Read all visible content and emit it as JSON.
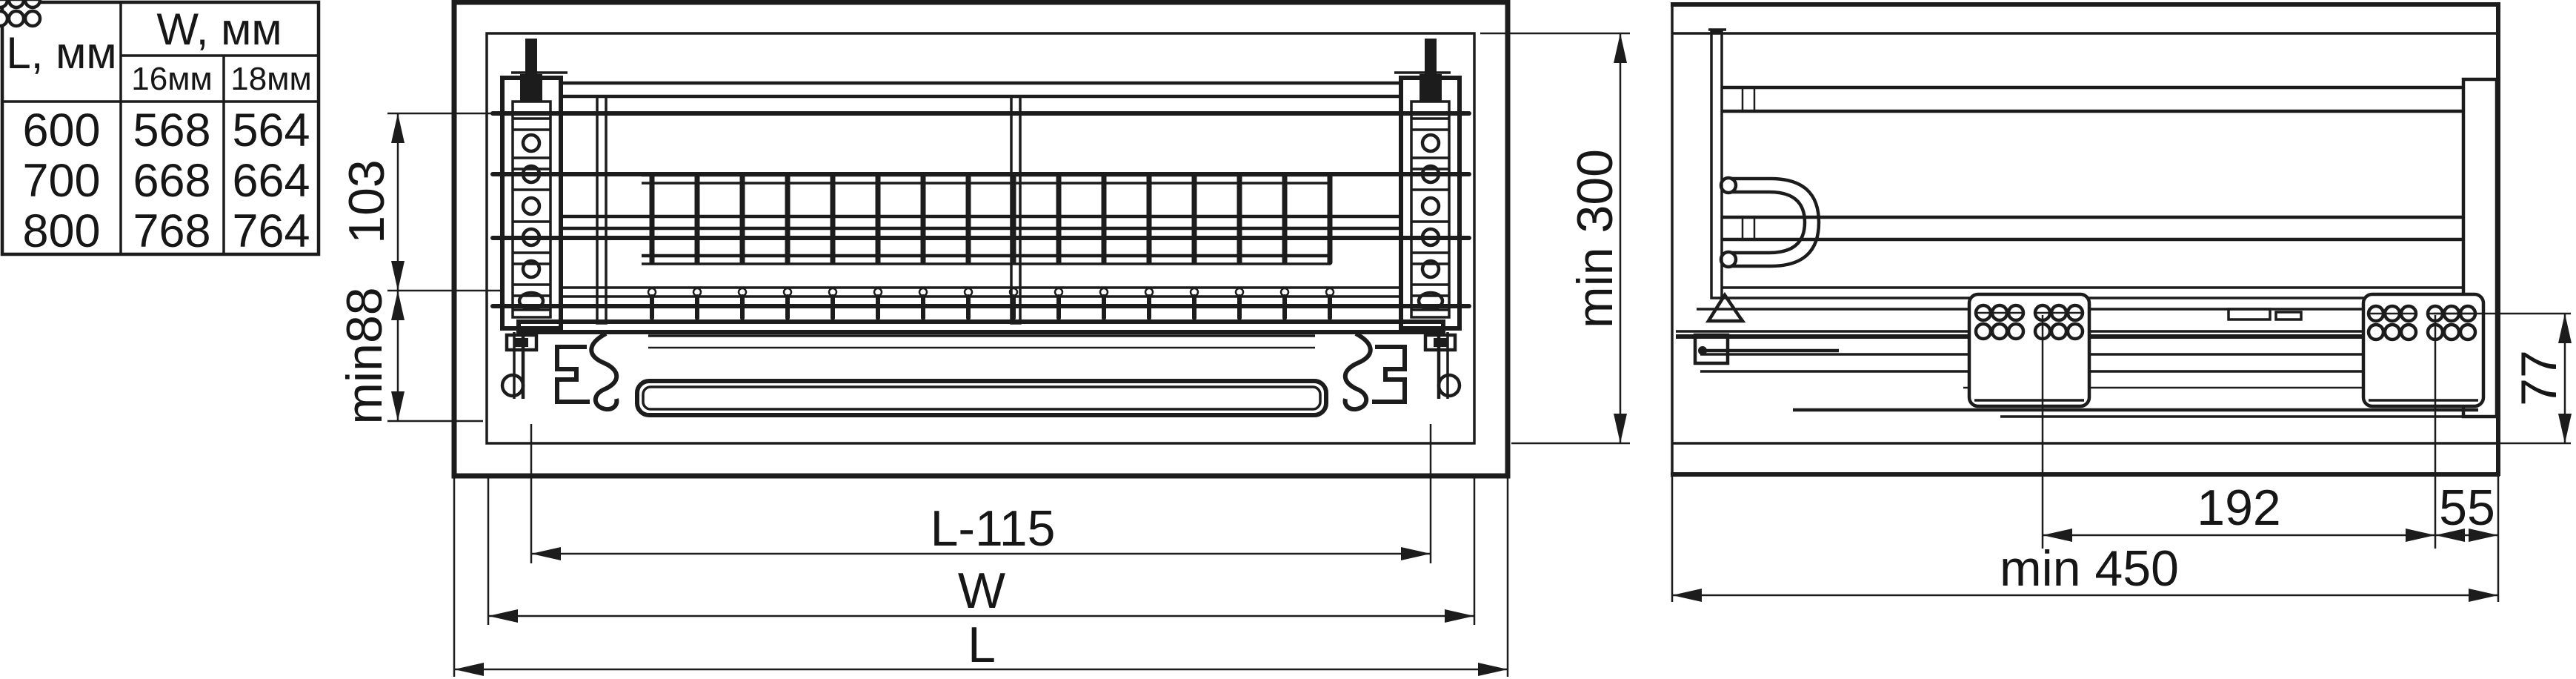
{
  "table": {
    "l_header": "L, мм",
    "w_header": "W, мм",
    "w_sub_16": "16мм",
    "w_sub_18": "18мм",
    "rows": [
      {
        "l": "600",
        "w16": "568",
        "w18": "564"
      },
      {
        "l": "700",
        "w16": "668",
        "w18": "664"
      },
      {
        "l": "800",
        "w16": "768",
        "w18": "764"
      }
    ]
  },
  "front_view": {
    "dim_top_section": "103",
    "dim_bottom_section": "min88",
    "dim_inner_height": "min 300",
    "dim_rail_span": "L-115",
    "dim_inner_width": "W",
    "dim_cabinet_width": "L"
  },
  "side_view": {
    "dim_slide_height": "77",
    "dim_hole_span": "192",
    "dim_back_gap": "55",
    "dim_min_depth": "min 450"
  },
  "colors": {
    "line": "#1c1c1c",
    "background": "#ffffff"
  }
}
